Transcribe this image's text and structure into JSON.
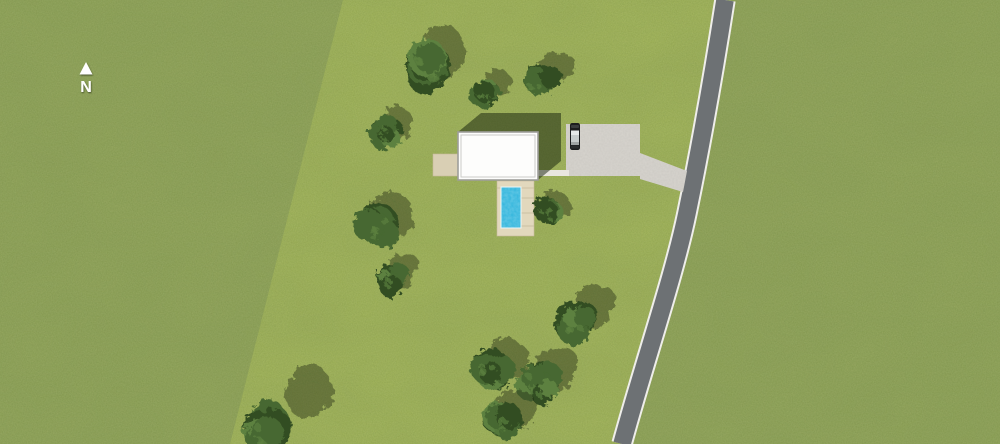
{
  "scene": {
    "type": "aerial-site-plan",
    "canvas": {
      "width": 1000,
      "height": 444
    },
    "compass": {
      "label": "N"
    },
    "colors": {
      "grass_outer": "#8ea257",
      "grass_parcel": "#a1b458",
      "road_surface": "#6d7174",
      "road_edge": "#efeeea",
      "gravel": "#d7d4ce",
      "path": "#e9e6df",
      "patio": "#d9cfb4",
      "deck": "#e2d8bd",
      "deck_seam": "#c6ba9c",
      "pool_water": "#31b5dc",
      "pool_rim": "#eaf6f8",
      "roof": "#fdfdfc",
      "roof_border": "#9e9e9a",
      "roof_inner_border": "#ccccc8",
      "shadow": "#121d0a",
      "canopy_dark": "#334d22",
      "canopy_mid": "#466830",
      "canopy_light": "#5d8140",
      "car_body": "#1c1d1e",
      "car_glass": "#e6e8e8",
      "car_roof": "#c7cbcb",
      "compass_color": "#ffffff"
    },
    "parcel_path": "M343,0 L725,0 C711,90 700,150 687,213 S645,360 622,444 L230,444 Z",
    "road": {
      "centerline": "M725,0 C711,90 700,150 687,213 S645,360 622,444",
      "surface_width": 17.5,
      "edge_width": 21.5
    },
    "house": {
      "x": 458,
      "y": 132,
      "w": 80,
      "h": 48,
      "shadow_points": "458,132 481,113 561,113 561,161 538,180 458,180"
    },
    "patio": {
      "x": 433,
      "y": 154,
      "w": 25,
      "h": 22
    },
    "access_path": {
      "x": 537,
      "y": 170,
      "w": 32,
      "h": 6
    },
    "parking": {
      "x": 566,
      "y": 124,
      "w": 74,
      "h": 52
    },
    "driveway_strip": {
      "points": "640,153 687,171 683,192 640,179"
    },
    "deck": {
      "x": 497,
      "y": 181,
      "w": 37,
      "h": 55,
      "seams": [
        198,
        213,
        226
      ],
      "top_seam": 188
    },
    "pool": {
      "x": 501,
      "y": 187,
      "w": 20,
      "h": 41
    },
    "car": {
      "x": 570,
      "y": 123,
      "w": 10,
      "h": 27
    },
    "trees": [
      {
        "x": 428,
        "y": 66,
        "r": 30,
        "sx": 16,
        "sy": -14
      },
      {
        "x": 486,
        "y": 93,
        "r": 18,
        "sx": 12,
        "sy": -10
      },
      {
        "x": 539,
        "y": 79,
        "r": 20,
        "sx": 14,
        "sy": -12
      },
      {
        "x": 385,
        "y": 131,
        "r": 18,
        "sx": 10,
        "sy": -9
      },
      {
        "x": 378,
        "y": 223,
        "r": 27,
        "sx": 14,
        "sy": -12
      },
      {
        "x": 390,
        "y": 278,
        "r": 18,
        "sx": 10,
        "sy": -9
      },
      {
        "x": 546,
        "y": 210,
        "r": 17,
        "sx": 8,
        "sy": -7
      },
      {
        "x": 575,
        "y": 320,
        "r": 26,
        "sx": 18,
        "sy": -16
      },
      {
        "x": 540,
        "y": 381,
        "r": 26,
        "sx": 16,
        "sy": -14
      },
      {
        "x": 491,
        "y": 366,
        "r": 24,
        "sx": 14,
        "sy": -12
      },
      {
        "x": 505,
        "y": 420,
        "r": 24,
        "sx": 14,
        "sy": -12
      },
      {
        "x": 268,
        "y": 429,
        "r": 30,
        "sx": 42,
        "sy": -36
      }
    ]
  }
}
